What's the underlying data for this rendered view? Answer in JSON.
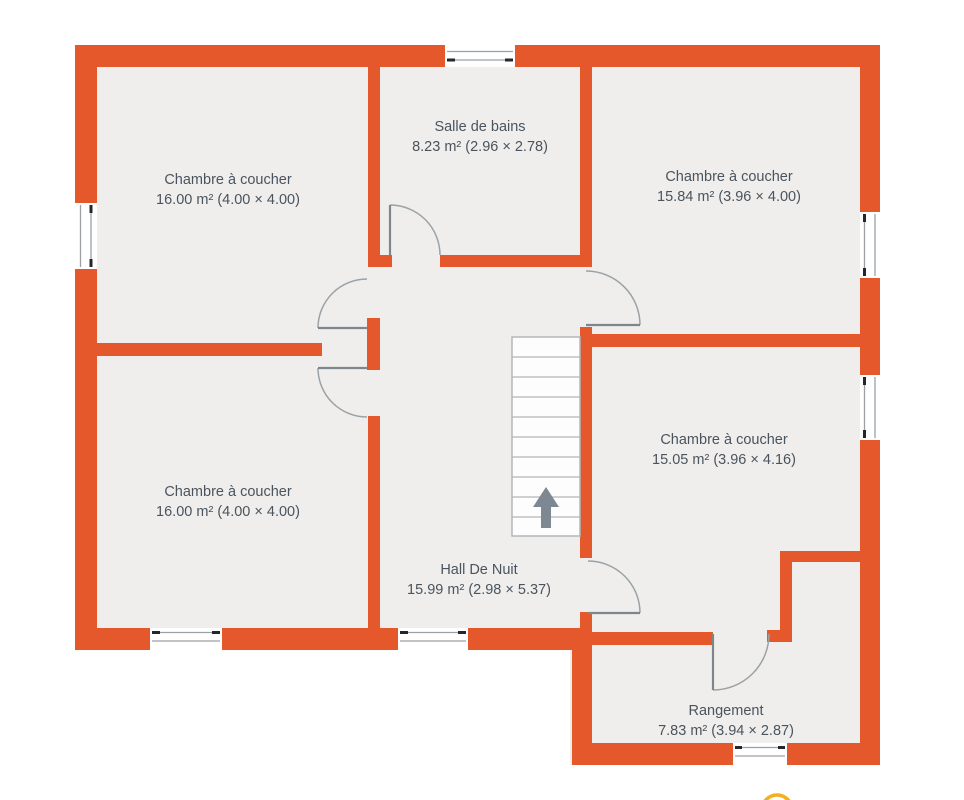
{
  "plan": {
    "rooms": [
      {
        "id": "bedroom-top-left",
        "name": "Chambre à coucher",
        "area": "16.00 m²",
        "dims": "(4.00 × 4.00)"
      },
      {
        "id": "bathroom",
        "name": "Salle de bains",
        "area": "8.23 m²",
        "dims": "(2.96 × 2.78)"
      },
      {
        "id": "bedroom-top-right",
        "name": "Chambre à coucher",
        "area": "15.84 m²",
        "dims": "(3.96 × 4.00)"
      },
      {
        "id": "bedroom-mid-right",
        "name": "Chambre à coucher",
        "area": "15.05 m²",
        "dims": "(3.96 × 4.16)"
      },
      {
        "id": "bedroom-bottom-left",
        "name": "Chambre à coucher",
        "area": "16.00 m²",
        "dims": "(4.00 × 4.00)"
      },
      {
        "id": "night-hall",
        "name": "Hall De Nuit",
        "area": "15.99 m²",
        "dims": "(2.98 × 5.37)"
      },
      {
        "id": "storage",
        "name": "Rangement",
        "area": "7.83 m²",
        "dims": "(3.94 × 2.87)"
      }
    ],
    "stairs": {
      "direction": "up",
      "steps": 10
    },
    "colors": {
      "wall": "#E4582B",
      "floor": "#EFEEEC",
      "label_text": "#4A545E",
      "door_swing": "#9AA2A8",
      "stairs_arrow": "#7E8893",
      "marker_ring": "#F2AF1E"
    }
  }
}
